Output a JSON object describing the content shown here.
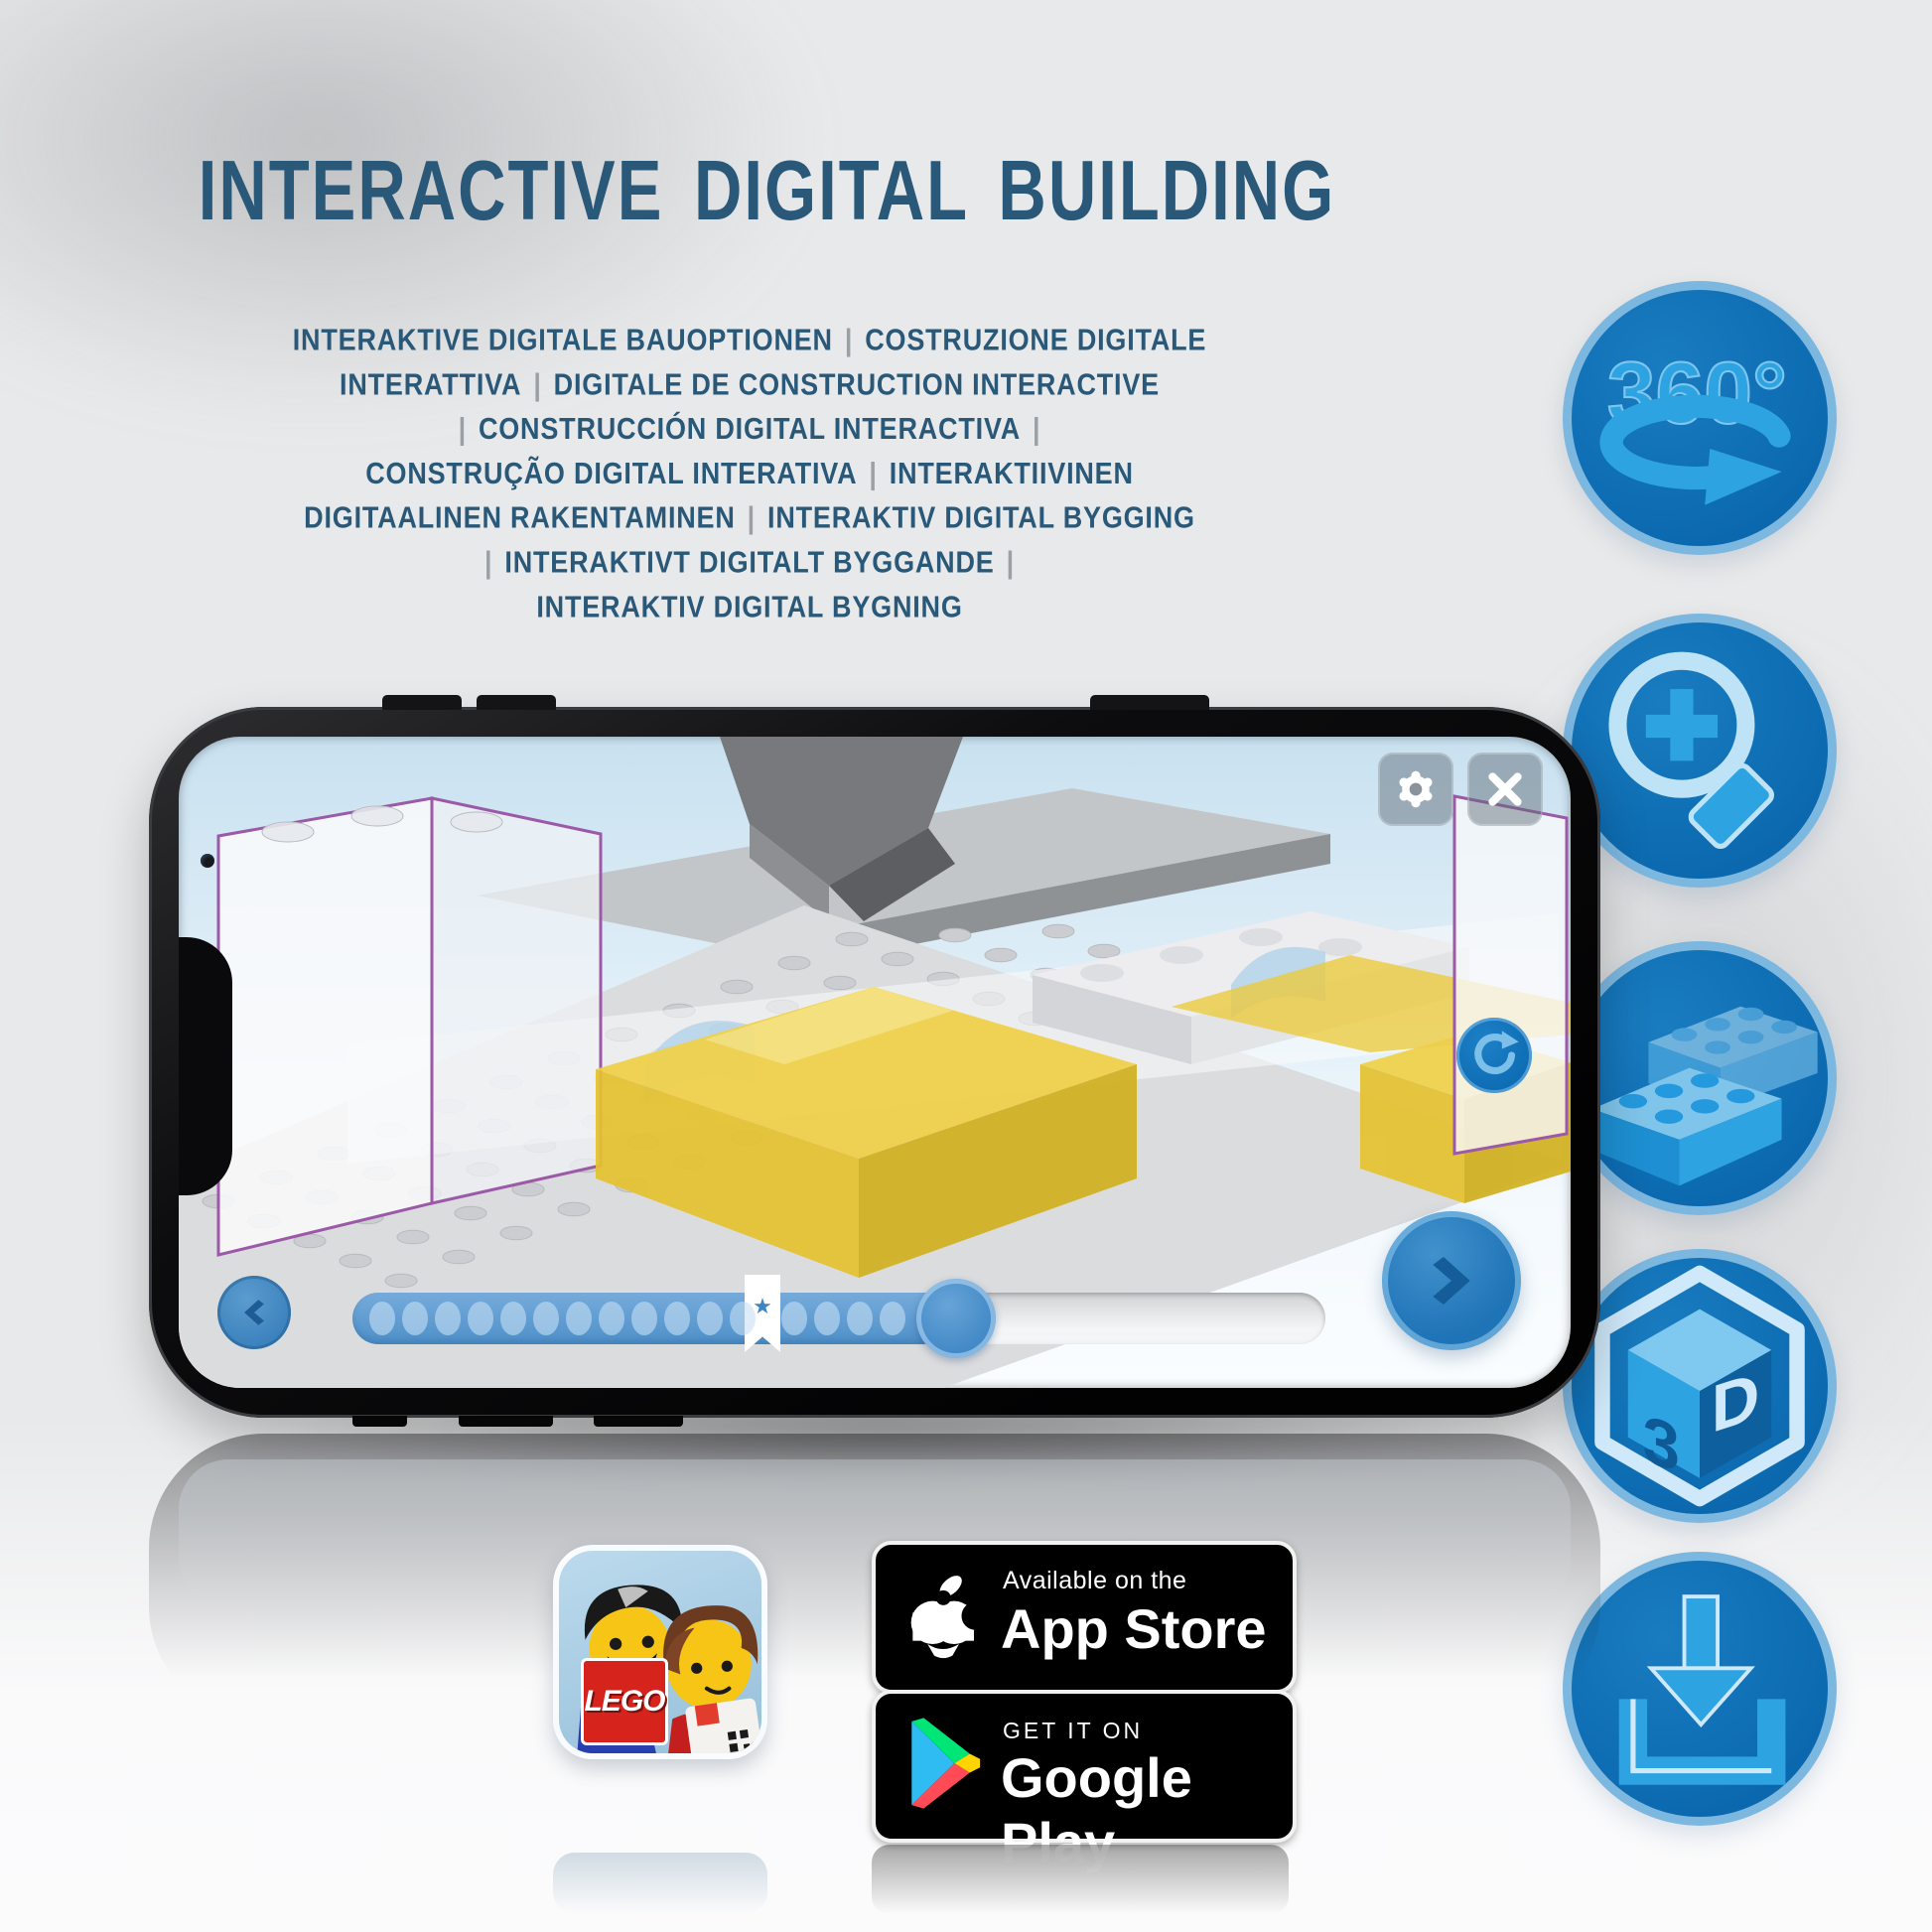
{
  "header": {
    "title": "INTERACTIVE DIGITAL BUILDING"
  },
  "subtitle": {
    "lines": [
      "INTERAKTIVE DIGITALE BAUOPTIONEN | COSTRUZIONE DIGITALE",
      "INTERATTIVA | DIGITALE DE CONSTRUCTION INTERACTIVE",
      "| CONSTRUCCIÓN DIGITAL INTERACTIVA |",
      "CONSTRUÇÃO DIGITAL INTERATIVA | INTERAKTIIVINEN",
      "DIGITAALINEN RAKENTAMINEN | INTERAKTIV DIGITAL BYGGING",
      "| INTERAKTIVT DIGITALT BYGGANDE |",
      "INTERAKTIV DIGITAL BYGNING"
    ]
  },
  "features": {
    "items": [
      {
        "id": "rotate-360",
        "label": "360°"
      },
      {
        "id": "zoom-in"
      },
      {
        "id": "brick"
      },
      {
        "id": "cube-3d",
        "left": "3",
        "right": "D"
      },
      {
        "id": "download"
      }
    ]
  },
  "phone": {
    "screen": {
      "toolbar": {
        "settings_icon": "gear",
        "close_icon": "x"
      },
      "controls": {
        "back": "chevron-left",
        "next": "chevron-right",
        "rotate": "circular-arrow"
      },
      "progress": {
        "dots_before_bookmark": 12,
        "dots_after_bookmark": 4,
        "filled_fraction": 0.64,
        "bookmark_star": "★"
      }
    }
  },
  "app_icon": {
    "logo_text": "LEGO"
  },
  "badges": {
    "app_store": {
      "line1": "Available on the",
      "line2": "App Store"
    },
    "google_play": {
      "line1": "GET IT ON",
      "line2": "Google Play"
    }
  },
  "colors": {
    "title_blue": "#2a5878",
    "circle_fill": "#0d6cb2",
    "circle_border": "#7cb7e0",
    "icon_blue": "#2ea3e2",
    "icon_light": "#c7e7f8",
    "progress_fill": "#4e90c9",
    "separator_gray": "#9aa0a4",
    "lego_red": "#d6231c",
    "yellow_brick": "#f0d149"
  }
}
